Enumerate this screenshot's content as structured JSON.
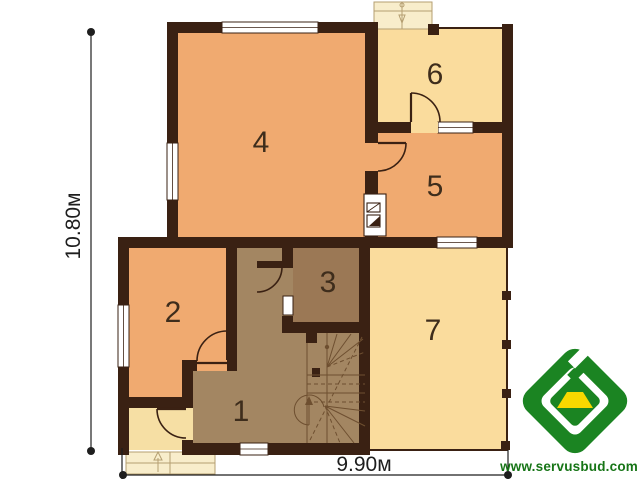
{
  "plan": {
    "rooms": [
      {
        "number": "1"
      },
      {
        "number": "2"
      },
      {
        "number": "3"
      },
      {
        "number": "4"
      },
      {
        "number": "5"
      },
      {
        "number": "6"
      },
      {
        "number": "7"
      }
    ],
    "dim_height": "10.80м",
    "dim_width": "9.90м"
  },
  "logo": {
    "website": "www.servusbud.com"
  },
  "colors": {
    "wall": "#3A2113",
    "orange": "#F0AA70",
    "yellow": "#FADC9D",
    "hall": "#A38662",
    "room3": "#9B7855",
    "vest": "#F6DFA4",
    "steps": "#F8EDCB",
    "outline": "#B59F72",
    "stair": "#6E4F30",
    "dim": "#1E1E1E",
    "label": "#3E2D1C",
    "window": "#FFFFFF",
    "logoGreen": "#1B8422",
    "logoYellow": "#F8D800",
    "logoText": "#177517"
  }
}
